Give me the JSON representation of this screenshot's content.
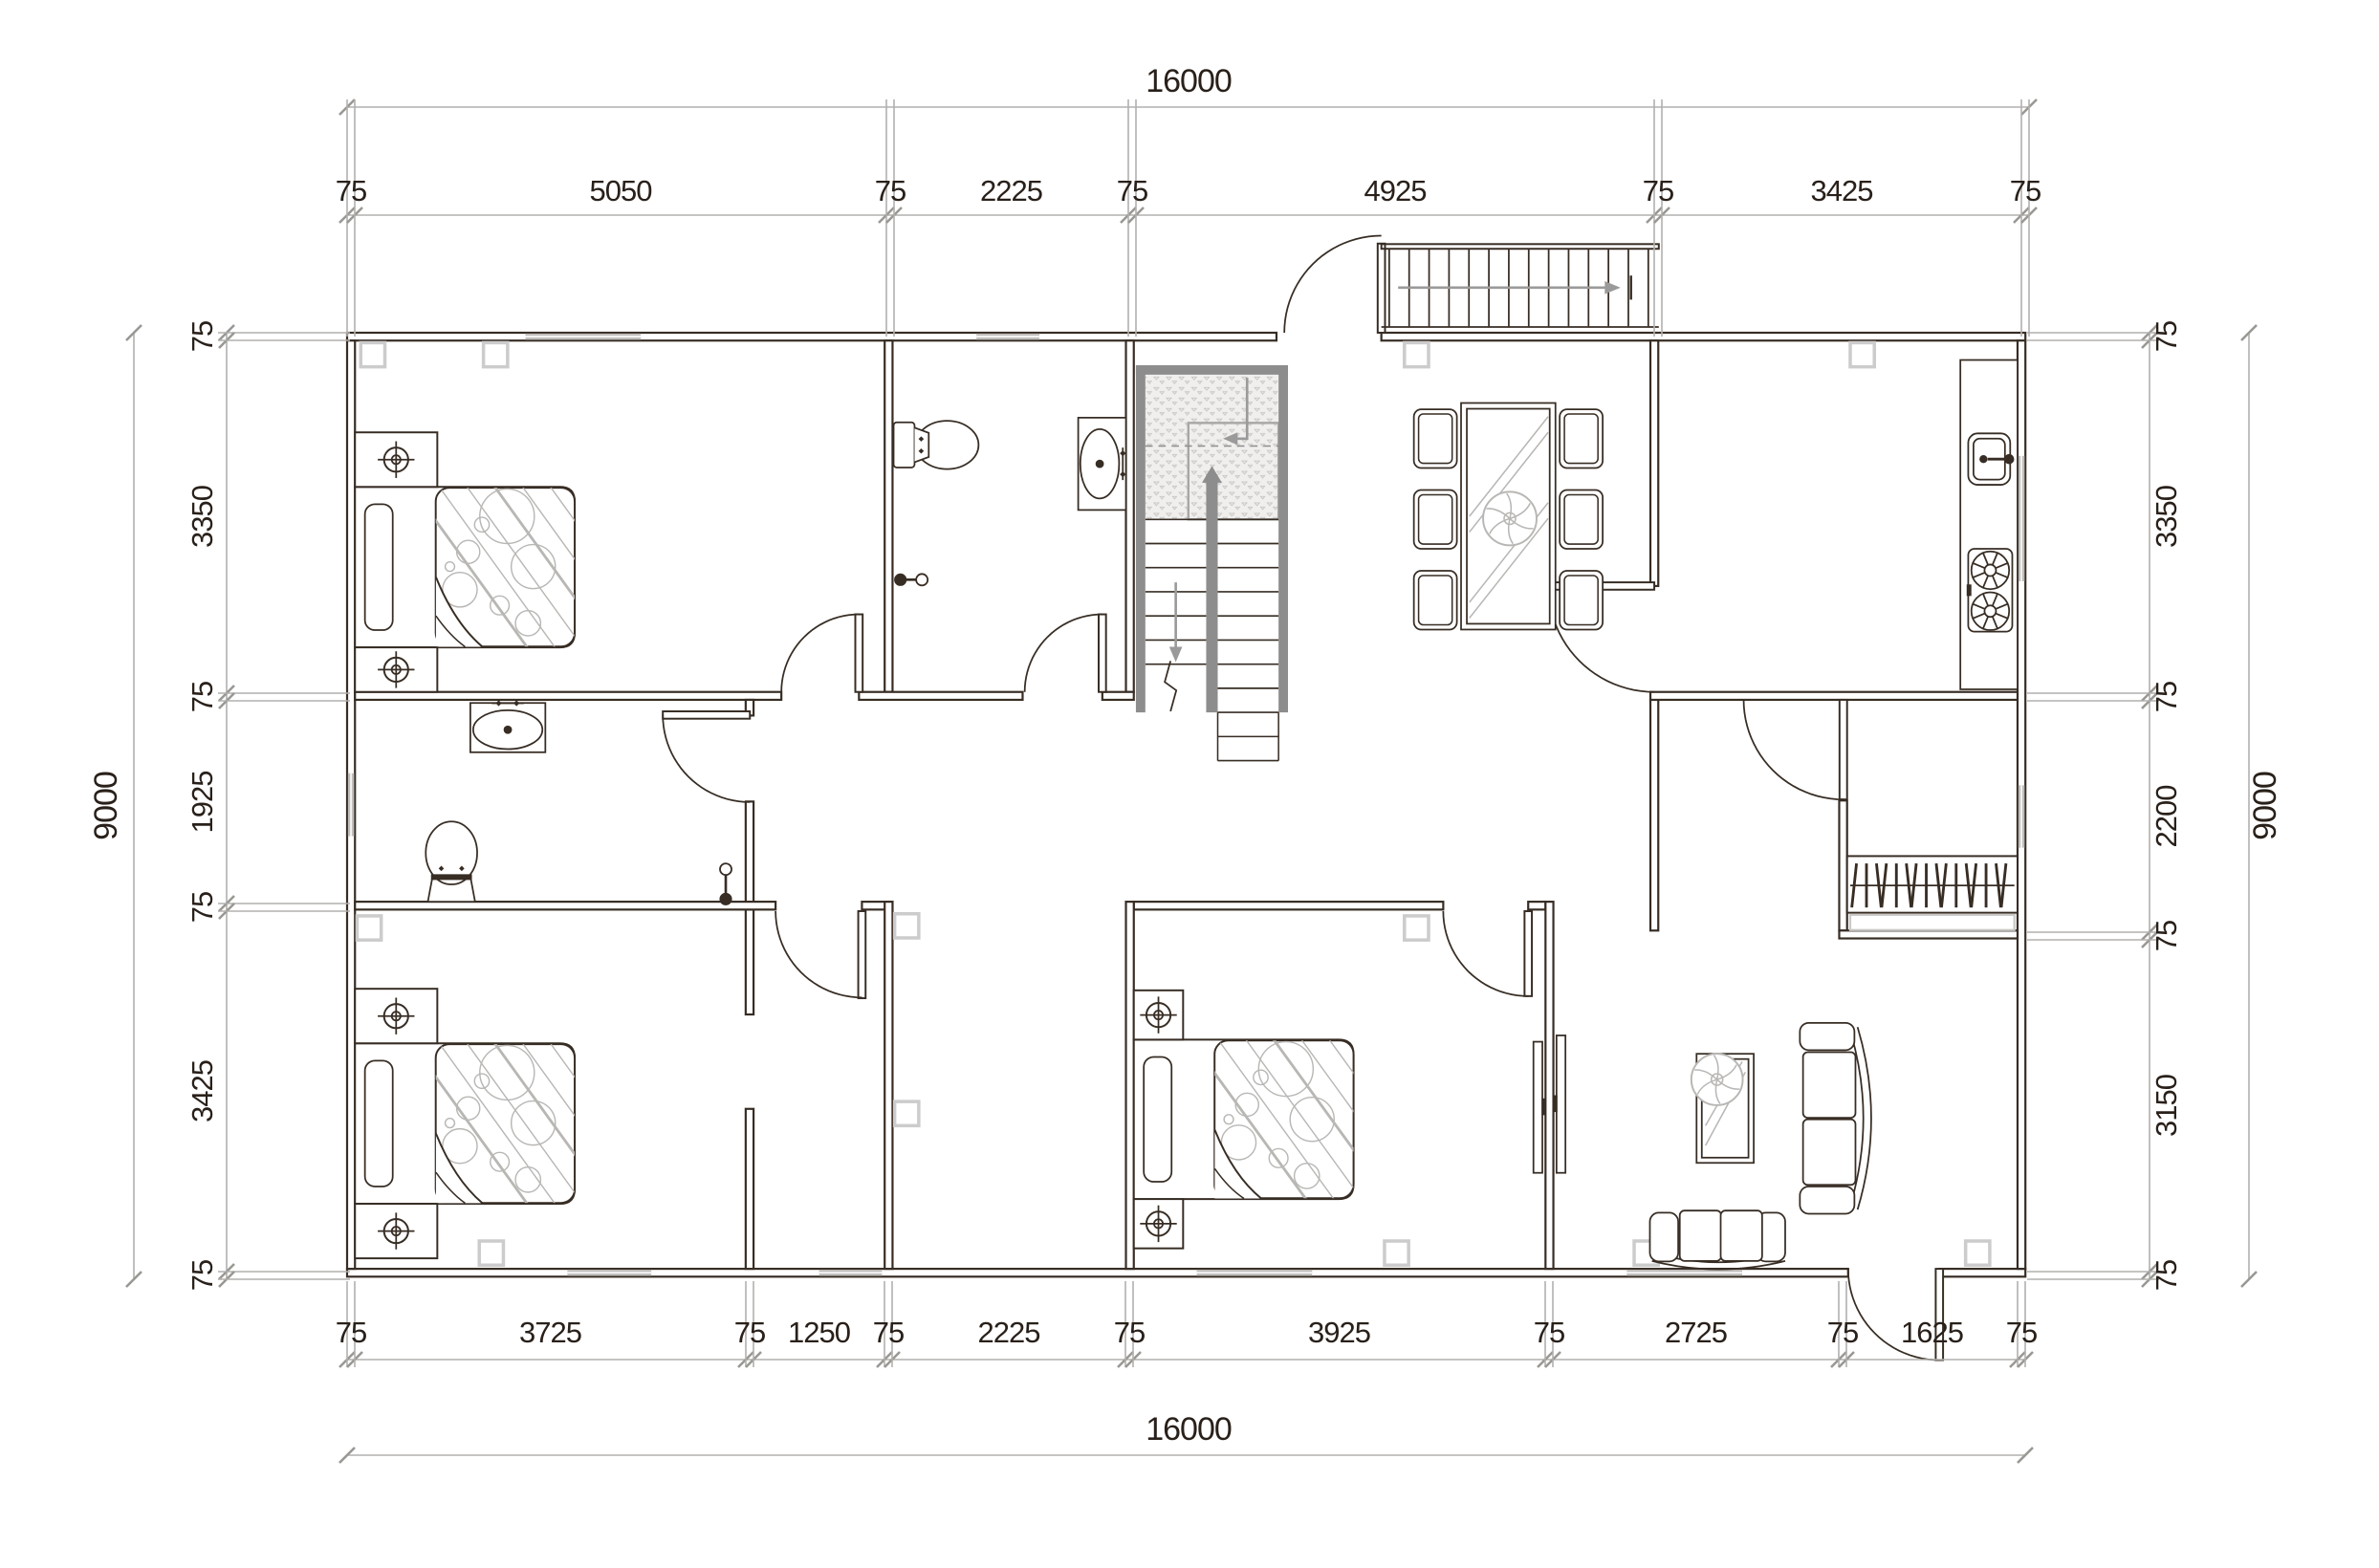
{
  "drawing": {
    "type": "architectural-floor-plan",
    "units": "mm",
    "overall_width_mm": 16000,
    "overall_height_mm": 9000
  },
  "dimensions": {
    "top": {
      "total": "16000",
      "segments": [
        "75",
        "5050",
        "75",
        "2225",
        "75",
        "4925",
        "75",
        "3425",
        "75"
      ]
    },
    "bottom": {
      "total": "16000",
      "segments": [
        "75",
        "3725",
        "75",
        "1250",
        "75",
        "2225",
        "75",
        "3925",
        "75",
        "2725",
        "75",
        "1625",
        "75"
      ]
    },
    "left": {
      "total": "9000",
      "segments": [
        "75",
        "3350",
        "75",
        "1925",
        "75",
        "3425",
        "75"
      ]
    },
    "right": {
      "total": "9000",
      "segments": [
        "75",
        "3350",
        "75",
        "2200",
        "75",
        "3150",
        "75"
      ]
    }
  },
  "colors": {
    "line": "#372d24",
    "dim_line": "#b2b0ad",
    "dim_text": "#29201a",
    "window": "#c0bebb",
    "stair": "#8d8d8d",
    "stair_arrow": "#9a9a9a",
    "pattern": "#b9b7b4",
    "column_marker": "#cccccc",
    "paper": "#ffffff"
  },
  "fixtures": [
    "double-bed",
    "pillow",
    "duvet-fold",
    "nightstand-lamp",
    "toilet",
    "vanity-sink",
    "shower-mixer",
    "staircase-dual-flight",
    "stair-landing-hatch",
    "down-arrow",
    "exterior-stair-railing",
    "dining-table-glass",
    "dining-chair",
    "potted-plant",
    "kitchen-counter",
    "kitchen-sink",
    "gas-stove-2-burner",
    "wardrobe-hangers",
    "wall-tv",
    "curved-sofa",
    "loveseat",
    "coffee-table-glass",
    "door-swing",
    "window",
    "column-marker"
  ]
}
